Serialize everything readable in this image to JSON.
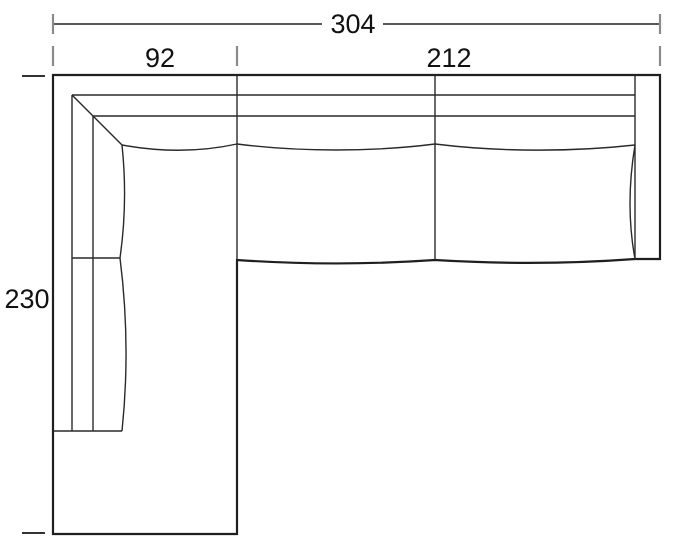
{
  "diagram": {
    "type": "furniture-floor-plan",
    "subject": "L-shaped sectional sofa with left chaise, top view schematic",
    "dimensions": {
      "overall_width": "304",
      "chaise_width": "92",
      "sofa_section_width": "212",
      "overall_depth": "230"
    },
    "colors": {
      "outline": "#1f1f1f",
      "inner_line": "#2a2a2a",
      "dimension_tick": "#8a8a8a",
      "dimension_line": "#222222",
      "text": "#111111",
      "background": "#ffffff"
    }
  }
}
